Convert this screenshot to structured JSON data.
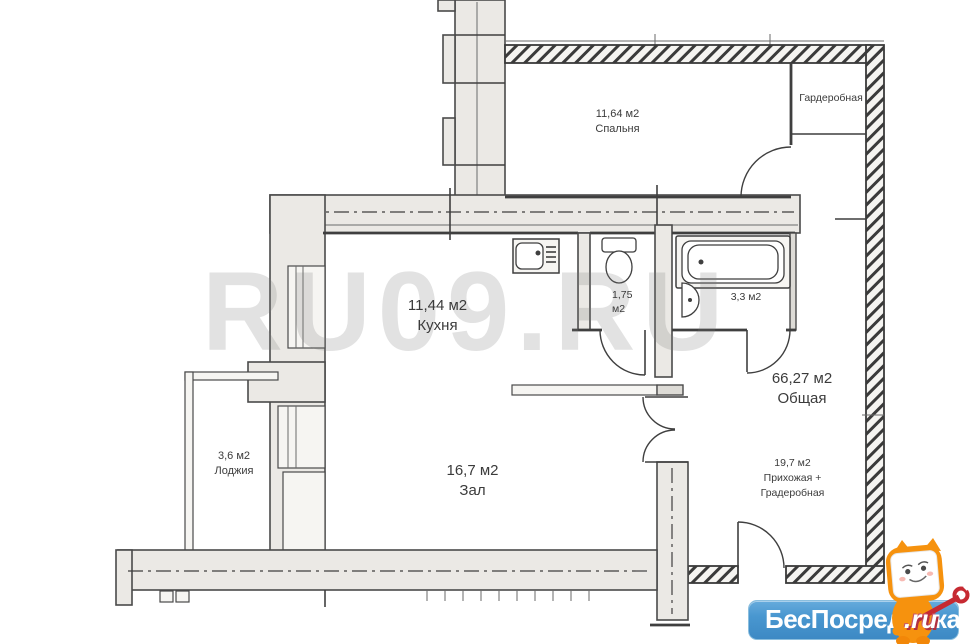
{
  "watermark_text": "RU09.RU",
  "rooms": {
    "bedroom": {
      "area": "11,64 м2",
      "name": "Спальня"
    },
    "wardrobe": {
      "name": "Гардеробная"
    },
    "kitchen": {
      "area": "11,44 м2",
      "name": "Кухня"
    },
    "wc": {
      "area": "1,75",
      "unit": "м2"
    },
    "bathroom": {
      "area": "3,3 м2"
    },
    "total": {
      "area": "66,27 м2",
      "name": "Общая"
    },
    "loggia": {
      "area": "3,6 м2",
      "name": "Лоджия"
    },
    "hall": {
      "area": "16,7 м2",
      "name": "Зал"
    },
    "entry": {
      "area": "19,7 м2",
      "name_line_1": "Прихожая +",
      "name_line_2": "Градеробная"
    }
  },
  "logo": {
    "brand": "БесПосредника",
    "domain_suffix": ".ru",
    "brand_bg_color": "#4694cd",
    "mascot": "orange-cat-with-red-wrench"
  },
  "plan_colors": {
    "wall_fill": "#ebe9e5",
    "line_color": "#3f3f3f",
    "watermark_color": "#c9c9c9",
    "hatch_color": "#3a3a3a"
  }
}
